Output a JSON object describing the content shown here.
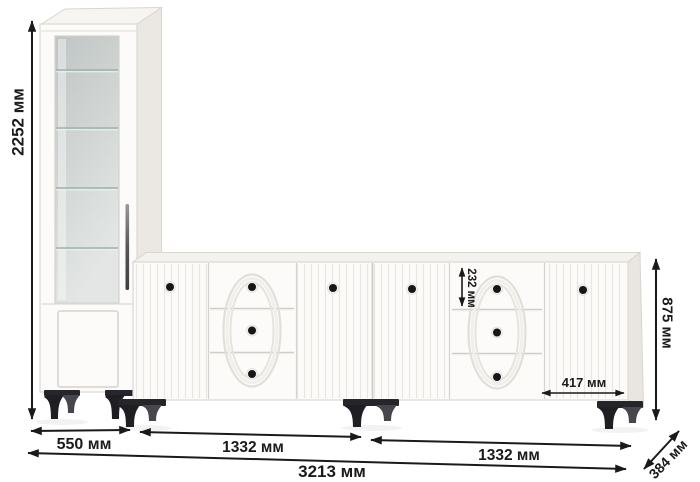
{
  "diagram": {
    "type": "furniture-dimension-drawing",
    "units": "мм",
    "pieces": [
      "tall-display-cabinet",
      "sideboard-left",
      "sideboard-right"
    ]
  },
  "dimensions": {
    "total_height": "2252 мм",
    "cabinet_width": "550 мм",
    "sideboard1_width": "1332 мм",
    "sideboard2_width": "1332 мм",
    "total_width": "3213 мм",
    "depth": "384 мм",
    "sideboard_height": "875 мм",
    "top_drawer_height": "232 мм",
    "right_door_width": "417 мм"
  },
  "icons": {
    "dimension_arrows": "double-headed-arrow"
  },
  "colors": {
    "background": "#ffffff",
    "furniture_body": "#fcfbf9",
    "furniture_side_shade": "#e9e6e1",
    "glass_tint": "#c9cfce",
    "legs": "#232327",
    "knobs": "#17171a",
    "dimension_ink": "#1a1a1a"
  }
}
